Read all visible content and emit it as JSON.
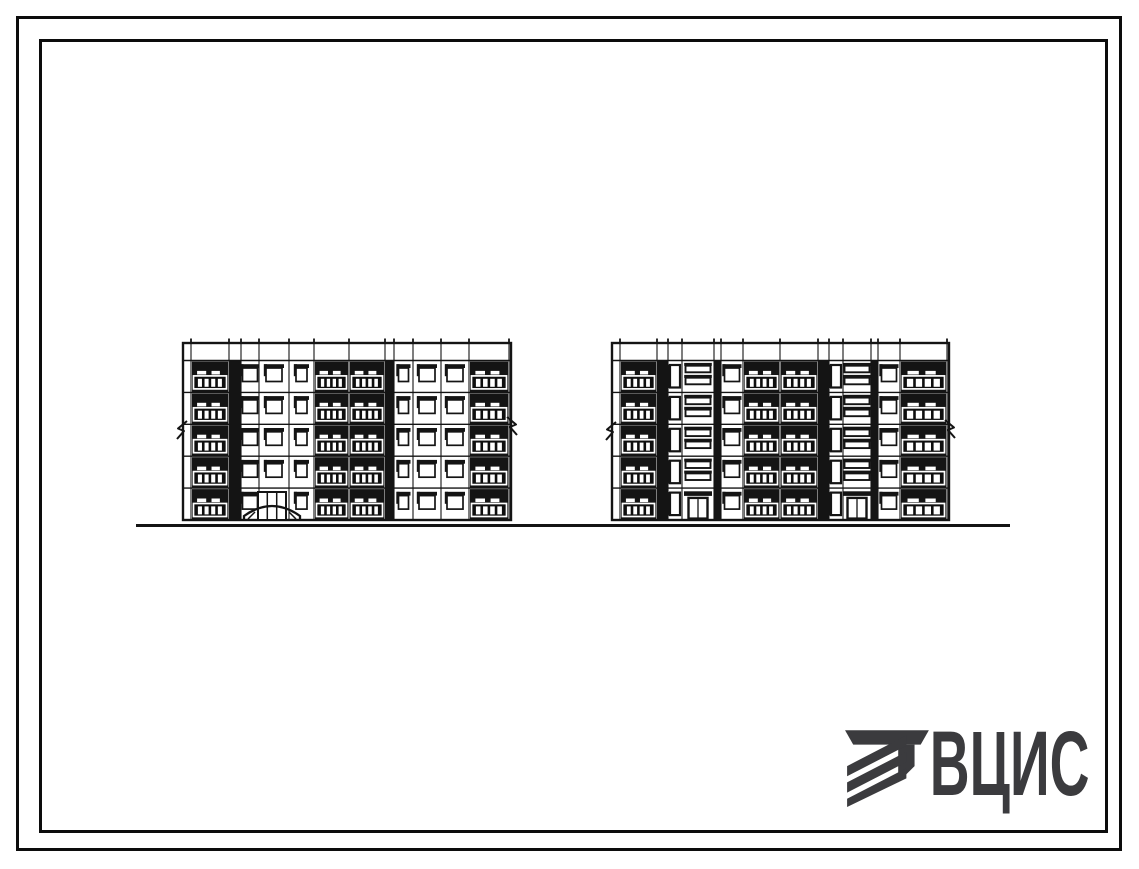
{
  "page": {
    "background": "#ffffff"
  },
  "frame": {
    "color": "#0c0c0c"
  },
  "logo": {
    "text": "ВЦИС",
    "color": "#3b3b3e"
  },
  "drawing": {
    "ink": "#141414",
    "ground": {
      "x1": 136,
      "x2": 1010,
      "y": 525.5,
      "stroke": 3
    },
    "levels": {
      "roof": 343,
      "parapet": 360.5,
      "bottom": 520,
      "floors": 5
    },
    "break_marks": [
      {
        "x": 183,
        "y": 430,
        "dir": -1
      },
      {
        "x": 511,
        "y": 426,
        "dir": 1
      },
      {
        "x": 612,
        "y": 431,
        "dir": -1
      },
      {
        "x": 949,
        "y": 429,
        "dir": 1
      }
    ],
    "buildings": [
      {
        "id": "left-building",
        "x1": 183,
        "x2": 511,
        "bays": [
          {
            "t": "end",
            "x1": 183,
            "x2": 191
          },
          {
            "t": "balcony",
            "x1": 191,
            "x2": 229
          },
          {
            "t": "shadow",
            "x1": 229,
            "x2": 241
          },
          {
            "t": "win",
            "x1": 241,
            "x2": 259,
            "w": 15
          },
          {
            "t": "win",
            "x1": 259,
            "x2": 289,
            "w": 16,
            "ground": "entrance"
          },
          {
            "t": "win",
            "x1": 289,
            "x2": 314,
            "w": 11
          },
          {
            "t": "balcony",
            "x1": 314,
            "x2": 349
          },
          {
            "t": "balcony",
            "x1": 349,
            "x2": 385
          },
          {
            "t": "shadow",
            "x1": 385,
            "x2": 394
          },
          {
            "t": "win",
            "x1": 394,
            "x2": 413,
            "w": 10
          },
          {
            "t": "win",
            "x1": 413,
            "x2": 441,
            "w": 16
          },
          {
            "t": "win",
            "x1": 441,
            "x2": 469,
            "w": 16
          },
          {
            "t": "balcony",
            "x1": 469,
            "x2": 509
          },
          {
            "t": "end",
            "x1": 509,
            "x2": 511
          }
        ],
        "entrances": [
          {
            "style": "arched",
            "cx": 272
          }
        ]
      },
      {
        "id": "right-building",
        "x1": 612,
        "x2": 949,
        "bays": [
          {
            "t": "end",
            "x1": 612,
            "x2": 620
          },
          {
            "t": "balcony",
            "x1": 620,
            "x2": 657
          },
          {
            "t": "shadow",
            "x1": 657,
            "x2": 668
          },
          {
            "t": "stairwin",
            "x1": 668,
            "x2": 682
          },
          {
            "t": "stairbars",
            "x1": 682,
            "x2": 714,
            "entrance": true
          },
          {
            "t": "shadow",
            "x1": 714,
            "x2": 721
          },
          {
            "t": "win",
            "x1": 721,
            "x2": 743,
            "w": 15
          },
          {
            "t": "balcony",
            "x1": 743,
            "x2": 780
          },
          {
            "t": "balcony",
            "x1": 780,
            "x2": 818
          },
          {
            "t": "shadow",
            "x1": 818,
            "x2": 829
          },
          {
            "t": "stairwin",
            "x1": 829,
            "x2": 843
          },
          {
            "t": "stairbars",
            "x1": 843,
            "x2": 871,
            "entrance": true
          },
          {
            "t": "shadow",
            "x1": 871,
            "x2": 878
          },
          {
            "t": "win",
            "x1": 878,
            "x2": 900,
            "w": 15
          },
          {
            "t": "balcony",
            "x1": 900,
            "x2": 947
          },
          {
            "t": "end",
            "x1": 947,
            "x2": 949
          }
        ],
        "entrances": []
      }
    ]
  }
}
